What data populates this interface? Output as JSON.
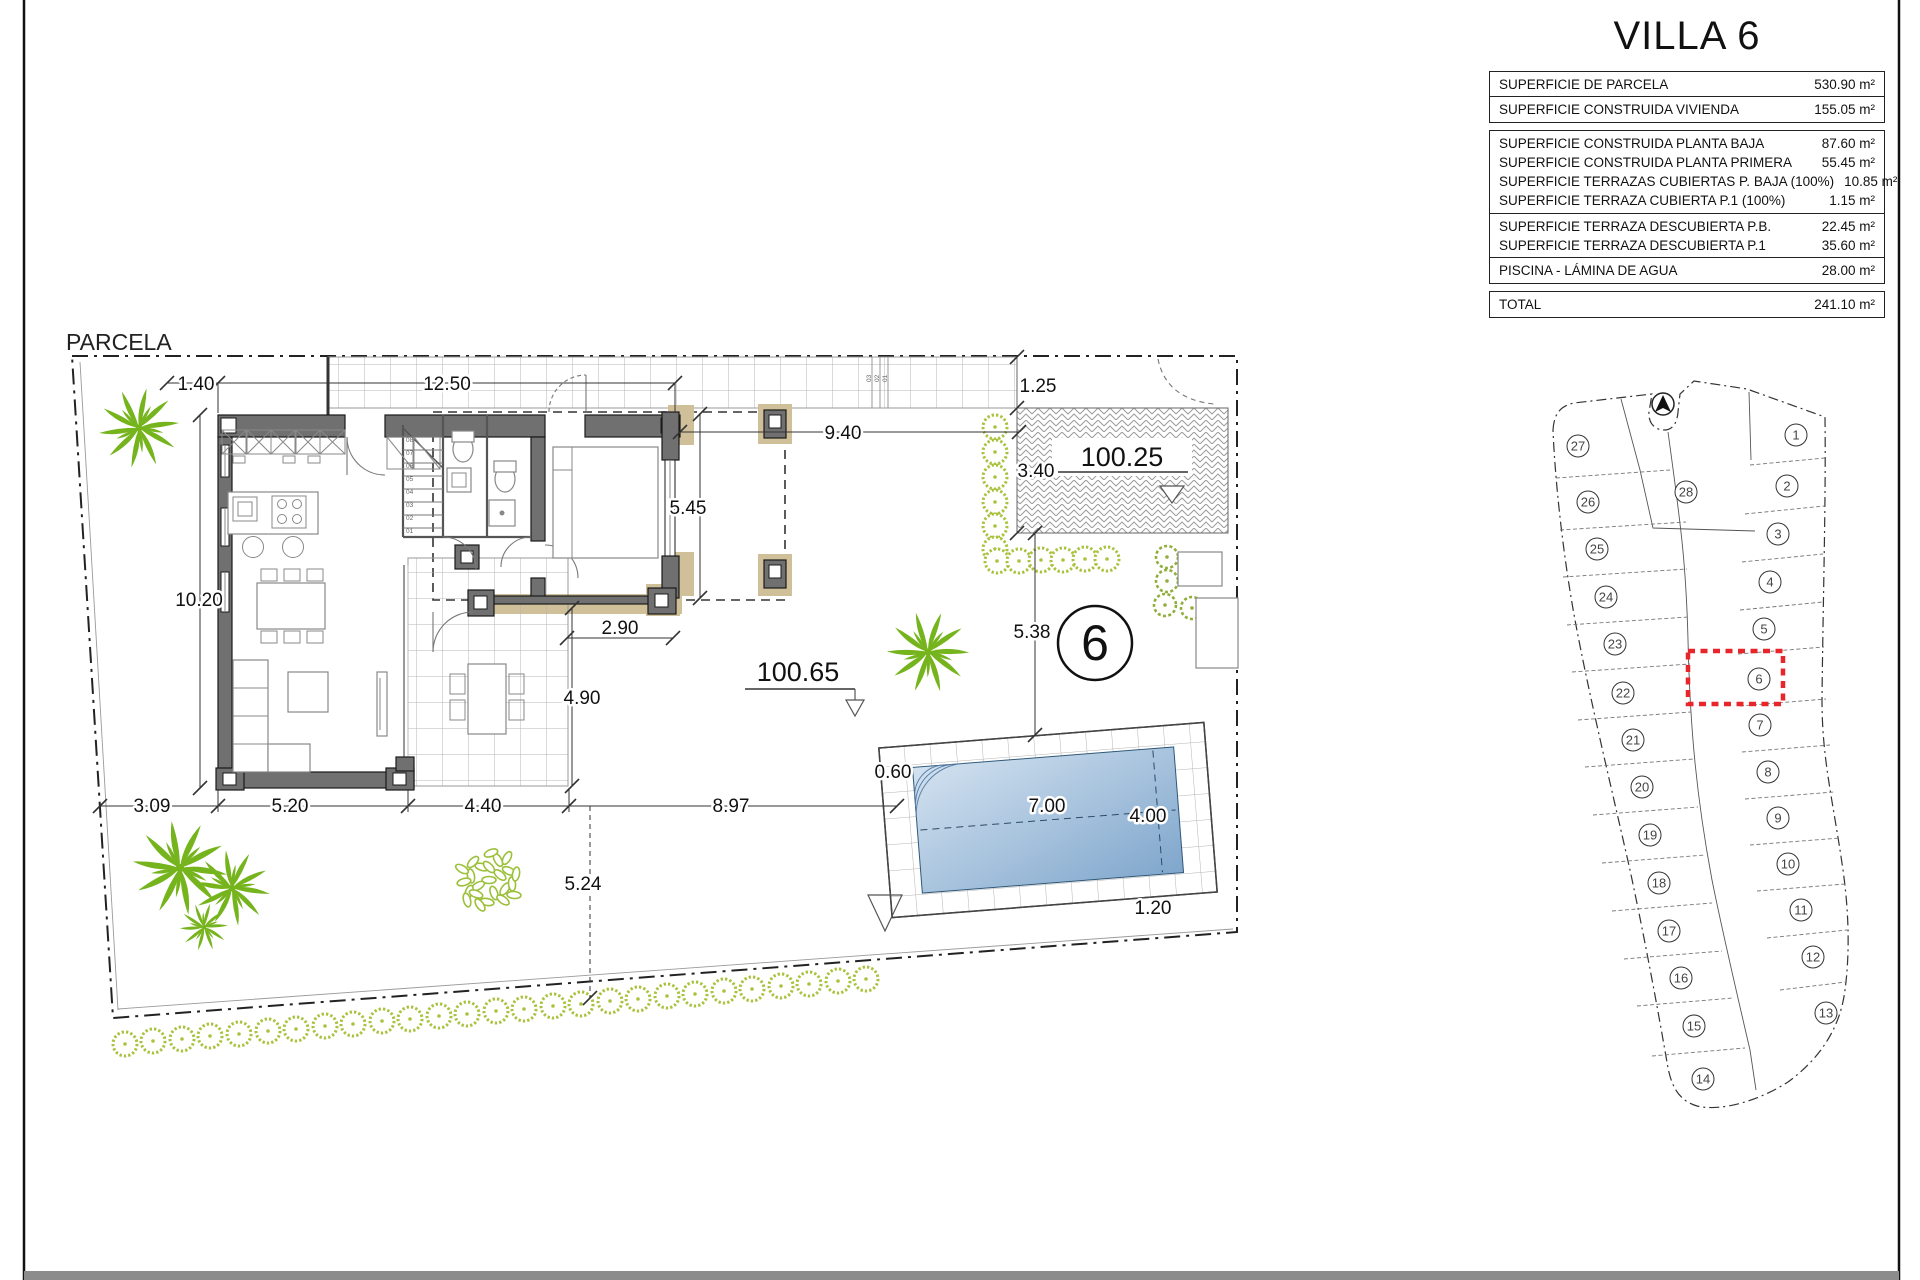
{
  "title_block": {
    "title": "VILLA 6",
    "groups": [
      {
        "rows": [
          {
            "label": "SUPERFICIE DE PARCELA",
            "value": "530.90 m²"
          }
        ]
      },
      {
        "rows": [
          {
            "label": "SUPERFICIE CONSTRUIDA VIVIENDA",
            "value": "155.05 m²"
          }
        ]
      },
      {
        "rows": [
          {
            "label": "SUPERFICIE CONSTRUIDA PLANTA BAJA",
            "value": "87.60 m²"
          },
          {
            "label": "SUPERFICIE CONSTRUIDA PLANTA PRIMERA",
            "value": "55.45 m²"
          },
          {
            "label": "SUPERFICIE TERRAZAS CUBIERTAS P. BAJA (100%)",
            "value": "10.85 m²"
          },
          {
            "label": "SUPERFICIE TERRAZA CUBIERTA P.1 (100%)",
            "value": "1.15 m²"
          }
        ]
      },
      {
        "rows": [
          {
            "label": "SUPERFICIE TERRAZA DESCUBIERTA P.B.",
            "value": "22.45 m²"
          },
          {
            "label": "SUPERFICIE TERRAZA DESCUBIERTA P.1",
            "value": "35.60 m²"
          }
        ]
      },
      {
        "rows": [
          {
            "label": "PISCINA - LÁMINA DE AGUA",
            "value": "28.00 m²"
          }
        ]
      },
      {
        "rows": [
          {
            "label": "TOTAL",
            "value": "241.10 m²"
          }
        ]
      }
    ]
  },
  "plan": {
    "area_label": "PARCELA",
    "plot_number": "6",
    "levels": {
      "driveway": "100.25",
      "garden": "100.65"
    },
    "dims": {
      "fence": "1.40",
      "front": "12.50",
      "front_right": "9.40",
      "walk": "1.25",
      "drive": "3.40",
      "upper": "5.45",
      "side": "10.20",
      "porch": "2.90",
      "terrace_d": "4.90",
      "pool_top": "5.38",
      "deck_l": "0.60",
      "pool_len": "7.00",
      "pool_w": "4.00",
      "deck_b": "1.20",
      "b1": "3.09",
      "b2": "5.20",
      "b3": "4.40",
      "b4": "8.97",
      "garden_d": "5.24"
    },
    "stairs": [
      "01",
      "02",
      "03",
      "04",
      "05",
      "06",
      "07",
      "08"
    ],
    "entry_steps": [
      "01",
      "02",
      "03"
    ]
  },
  "site_plan": {
    "plots": [
      "1",
      "2",
      "3",
      "4",
      "5",
      "6",
      "7",
      "8",
      "9",
      "10",
      "11",
      "12",
      "13",
      "14",
      "15",
      "16",
      "17",
      "18",
      "19",
      "20",
      "21",
      "22",
      "23",
      "24",
      "25",
      "26",
      "27",
      "28"
    ],
    "highlighted": "6",
    "highlight_color": "#e8252a"
  },
  "colors": {
    "wall": "#707070",
    "tan": "#cfc09a",
    "palm": "#76b41e",
    "bush": "#a9c33f",
    "pool_light": "#cfe0ef",
    "pool_dark": "#7fa6cc",
    "footer": "#8c8c8c"
  }
}
